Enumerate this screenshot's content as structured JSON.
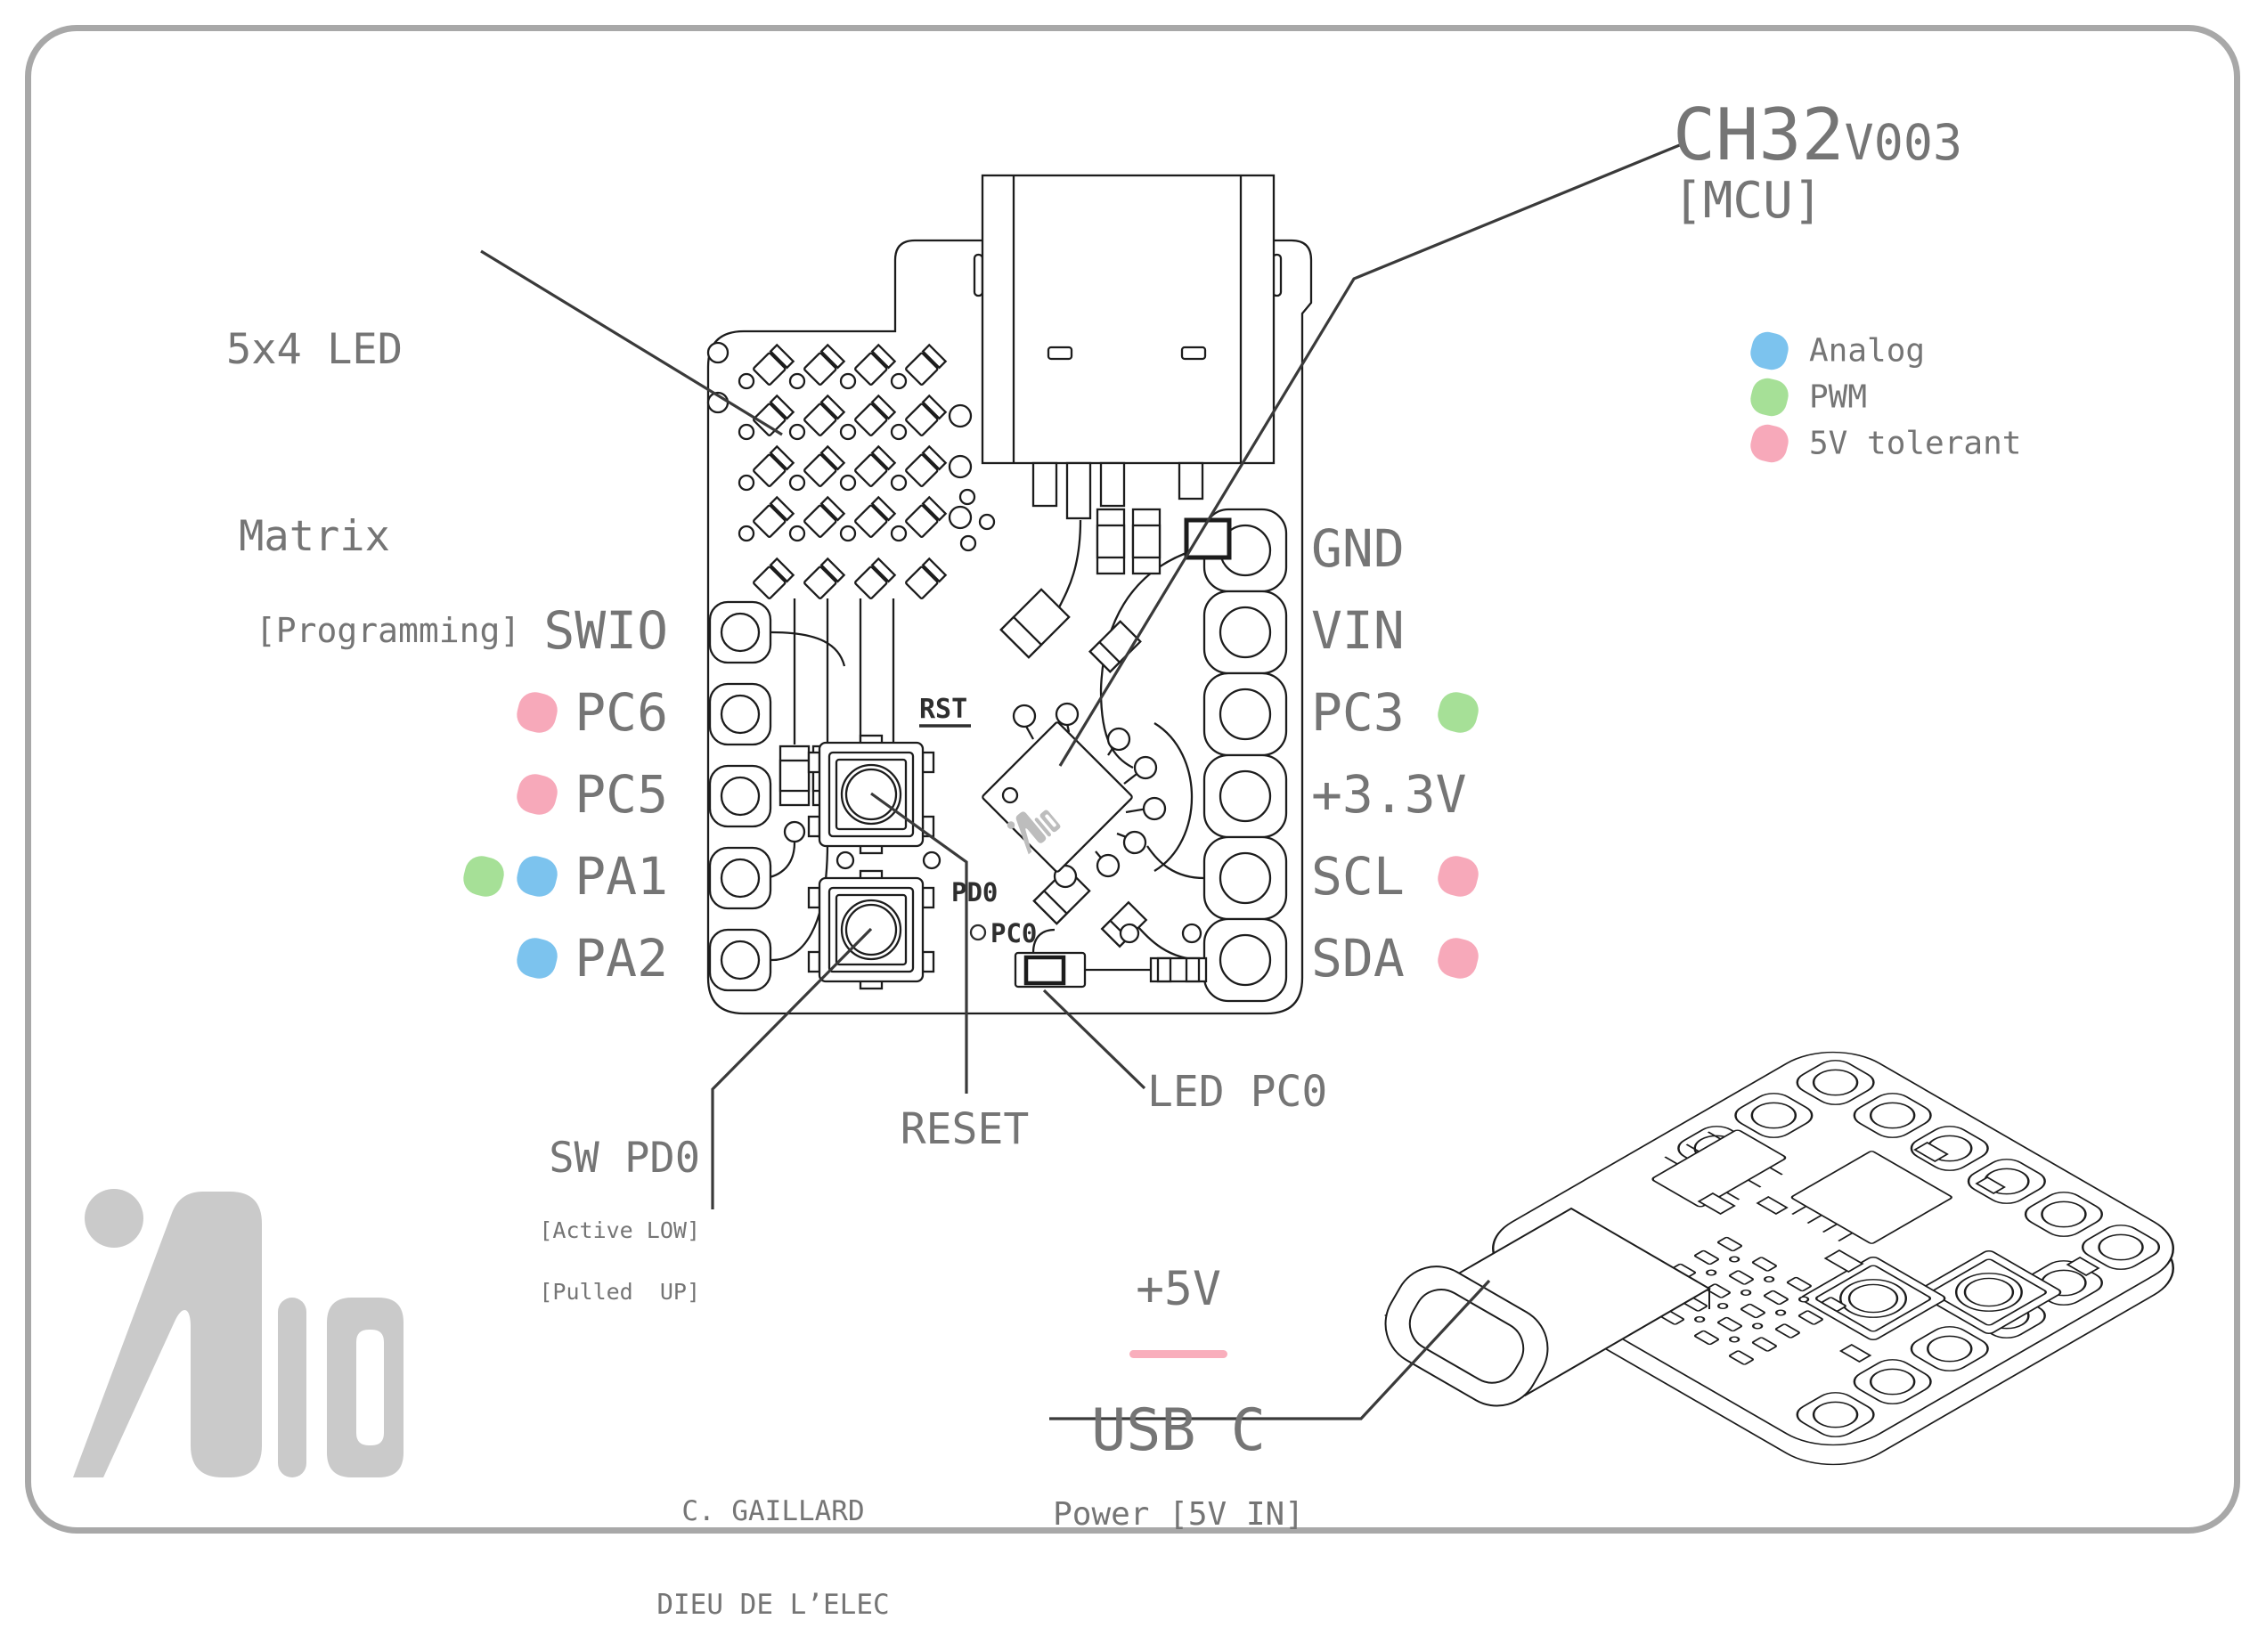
{
  "colors": {
    "analog": "#7cc3ee",
    "pwm": "#a6e097",
    "tolerant5v": "#f7a9ba",
    "underline": "#f9aebc"
  },
  "legend": {
    "items": [
      {
        "id": "analog",
        "label": "Analog"
      },
      {
        "id": "pwm",
        "label": "PWM"
      },
      {
        "id": "tolerant5v",
        "label": "5V tolerant"
      }
    ]
  },
  "callouts": {
    "led_matrix": {
      "line1": "5x4 LED",
      "line2": "Matrix"
    },
    "mcu": {
      "name": "CH32",
      "variant": "V003",
      "type": "[MCU]"
    },
    "sw_pd0": {
      "title": "SW PD0",
      "note_active": "[Active LOW]",
      "note_pull": "[Pulled  UP]"
    },
    "reset": {
      "label": "RESET"
    },
    "led_pc0": {
      "label": "LED PC0"
    },
    "usb": {
      "voltage": "+5V",
      "title": "USB C",
      "subtitle": "Power [5V IN]"
    }
  },
  "pins": {
    "left": [
      {
        "prefix": "[Programming]",
        "name": "SWIO",
        "dots": []
      },
      {
        "name": "PC6",
        "dots": [
          "tolerant5v"
        ]
      },
      {
        "name": "PC5",
        "dots": [
          "tolerant5v"
        ]
      },
      {
        "name": "PA1",
        "dots": [
          "pwm",
          "analog"
        ]
      },
      {
        "name": "PA2",
        "dots": [
          "analog"
        ]
      }
    ],
    "right": [
      {
        "name": "GND",
        "dots": []
      },
      {
        "name": "VIN",
        "dots": []
      },
      {
        "name": "PC3",
        "dots": [
          "pwm"
        ]
      },
      {
        "name": "+3.3V",
        "dots": []
      },
      {
        "name": "SCL",
        "dots": [
          "tolerant5v"
        ]
      },
      {
        "name": "SDA",
        "dots": [
          "tolerant5v"
        ]
      }
    ]
  },
  "silkscreen": {
    "rst": "RST",
    "pd0": "PD0",
    "pc0": "PC0"
  },
  "credit": {
    "line1": "C. GAILLARD",
    "line2": "DIEU DE L’ELEC"
  }
}
